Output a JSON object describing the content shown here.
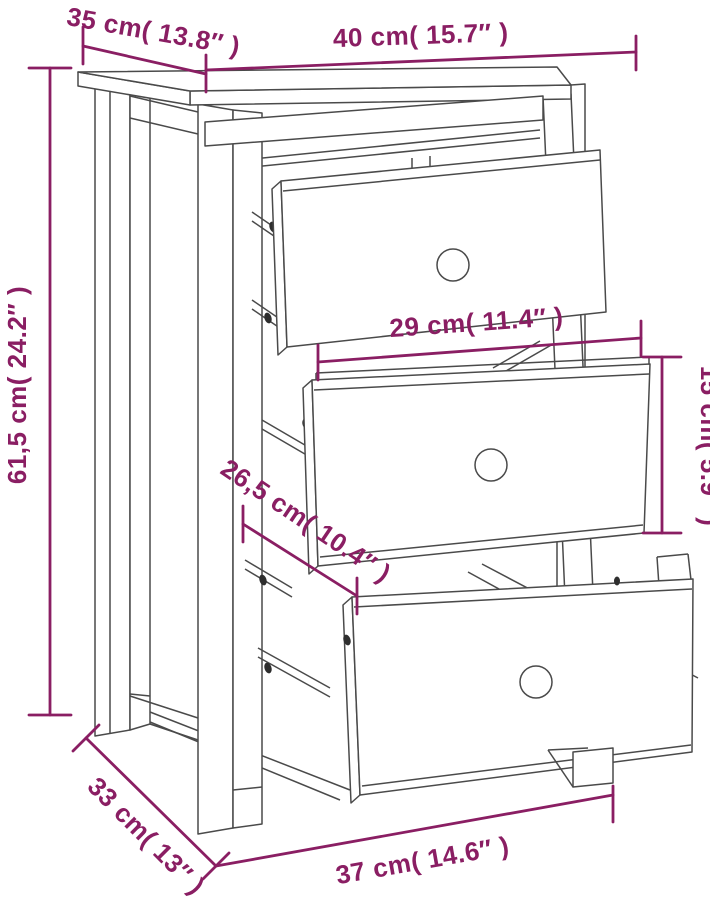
{
  "diagram": {
    "type": "product-dimension-diagram",
    "product": "bedside-cabinet-with-3-drawers",
    "background_color": "#ffffff",
    "line_color": "#4a4a4a",
    "dimension_color": "#8a1e63",
    "dimensions": {
      "top_depth": {
        "label": "35 cm( 13.8″ )",
        "cm": "35",
        "inches": "13.8"
      },
      "top_width": {
        "label": "40 cm( 15.7″ )",
        "cm": "40",
        "inches": "15.7"
      },
      "height": {
        "label": "61,5 cm( 24.2″ )",
        "cm": "61,5",
        "inches": "24.2"
      },
      "drawer_width": {
        "label": "29 cm( 11.4″ )",
        "cm": "29",
        "inches": "11.4"
      },
      "drawer_height": {
        "label": "15 cm( 5.9″ )",
        "cm": "15",
        "inches": "5.9"
      },
      "drawer_depth": {
        "label": "26,5 cm( 10.4″ )",
        "cm": "26,5",
        "inches": "10.4"
      },
      "base_depth": {
        "label": "33 cm( 13″ )",
        "cm": "33",
        "inches": "13"
      },
      "base_width": {
        "label": "37 cm( 14.6″ )",
        "cm": "37",
        "inches": "14.6"
      }
    }
  }
}
